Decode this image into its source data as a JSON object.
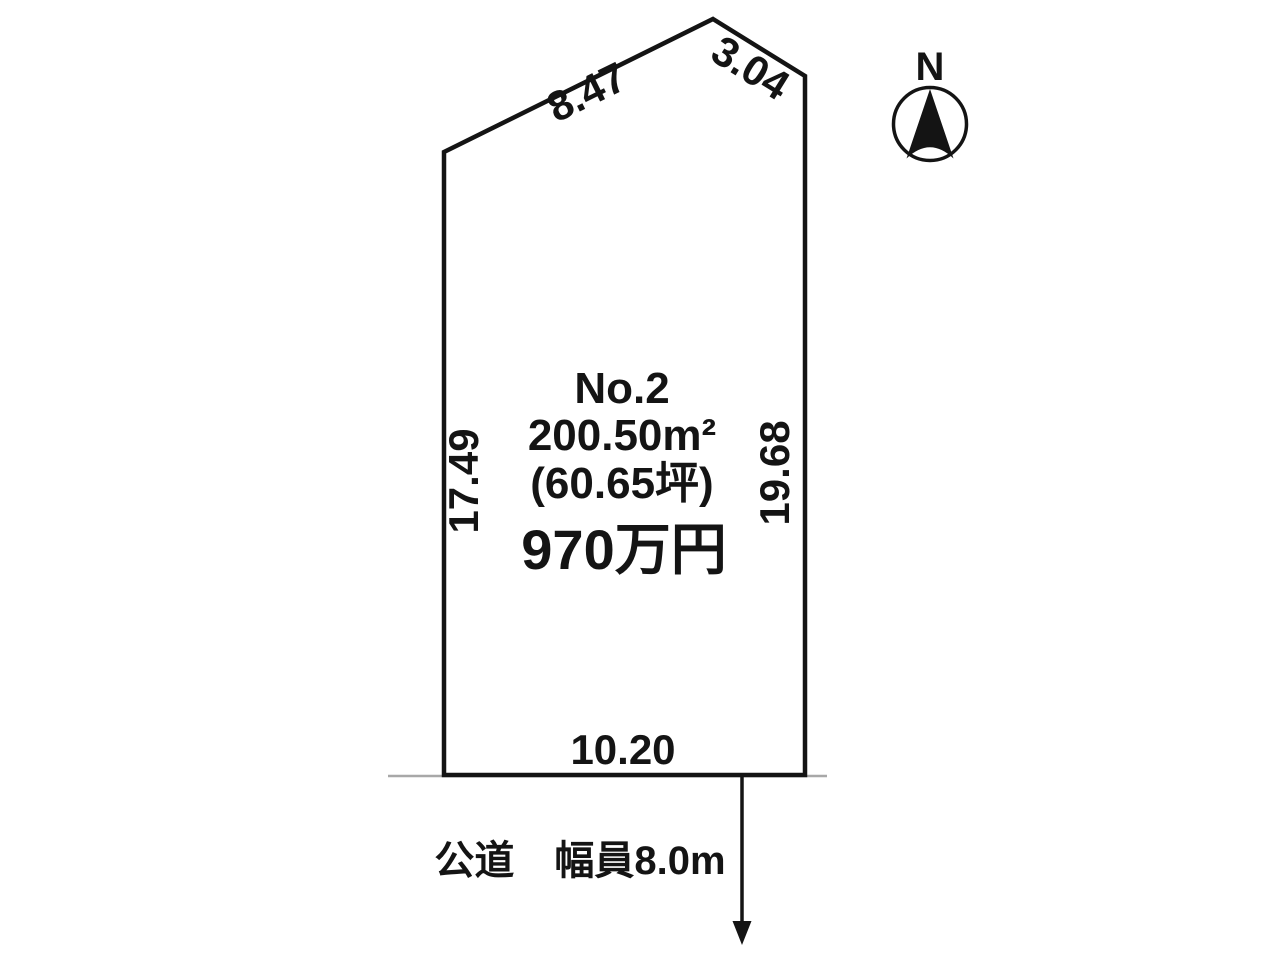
{
  "plot": {
    "label": "No.2",
    "area_m2": "200.50m²",
    "area_tsubo": "(60.65坪)",
    "price": "970万円"
  },
  "dimensions": {
    "edge_top_left": "8.47",
    "edge_top_right": "3.04",
    "edge_left": "17.49",
    "edge_right": "19.68",
    "edge_bottom": "10.20"
  },
  "road": {
    "label": "公道　幅員8.0m"
  },
  "compass": {
    "north_label": "N"
  },
  "colors": {
    "outline": "#141414",
    "price_red": "#ee1111",
    "road_gray": "#a8a8a8"
  }
}
